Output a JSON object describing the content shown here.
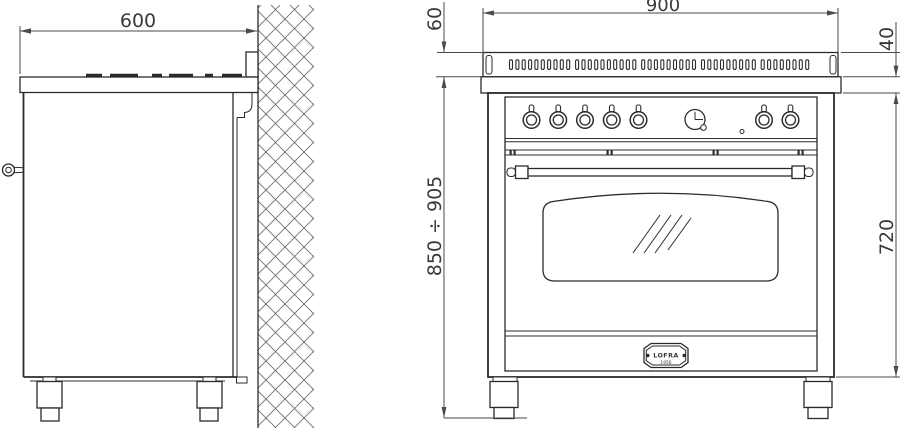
{
  "drawing_title": "range cooker installation drawing",
  "colors": {
    "line": "#2b2b2b",
    "dim_line": "#4a4a4a",
    "dim_text": "#3a3a3a",
    "background": "#ffffff"
  },
  "dimensions": {
    "depth": "600",
    "width": "900",
    "backguard_height": "60",
    "worktop_thickness": "40",
    "working_height_range": "850 ÷ 905",
    "body_height": "720"
  },
  "badge": {
    "brand": "LOFRA",
    "year": "1956"
  },
  "controls": {
    "left_knob_count": 5,
    "right_knob_count": 2,
    "has_clock": true,
    "indicator_light_count": 1
  },
  "vent_grille": {
    "slot_count": 46
  }
}
